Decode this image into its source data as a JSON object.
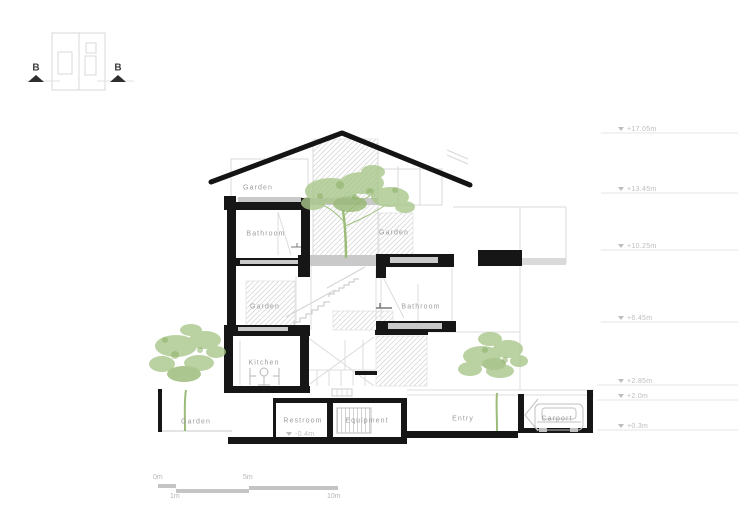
{
  "rooms": {
    "roof_garden": "Garden",
    "l3_bathroom": "Bathroom",
    "l3_garden": "Garden",
    "l2_garden": "Garden",
    "l2_bathroom": "Bathroom",
    "kitchen": "Kitchen",
    "ground_garden": "Garden",
    "restroom": "Restroom",
    "equipment": "Equipment",
    "entry": "Entry",
    "carport": "Carport"
  },
  "levels": [
    {
      "label": "+17.05m"
    },
    {
      "label": "+13.45m"
    },
    {
      "label": "+10.25m"
    },
    {
      "label": "+6.45m"
    },
    {
      "label": "+2.85m"
    },
    {
      "label": "+2.0m"
    },
    {
      "label": "+0.3m"
    }
  ],
  "sub_level_label": "-0.4m",
  "key_plan": {
    "marker_left": "B",
    "marker_right": "B"
  },
  "scale_bar": {
    "zero": "0m",
    "one": "1m",
    "five": "5m",
    "ten": "10m"
  },
  "colors": {
    "cut_black": "#161616",
    "line_gray": "#d8d8d8",
    "slab_gray": "#c9c9c9",
    "label_gray": "#9c9c9c",
    "level_gray": "#bdbdbd",
    "tree_green": "#a9c78a"
  }
}
